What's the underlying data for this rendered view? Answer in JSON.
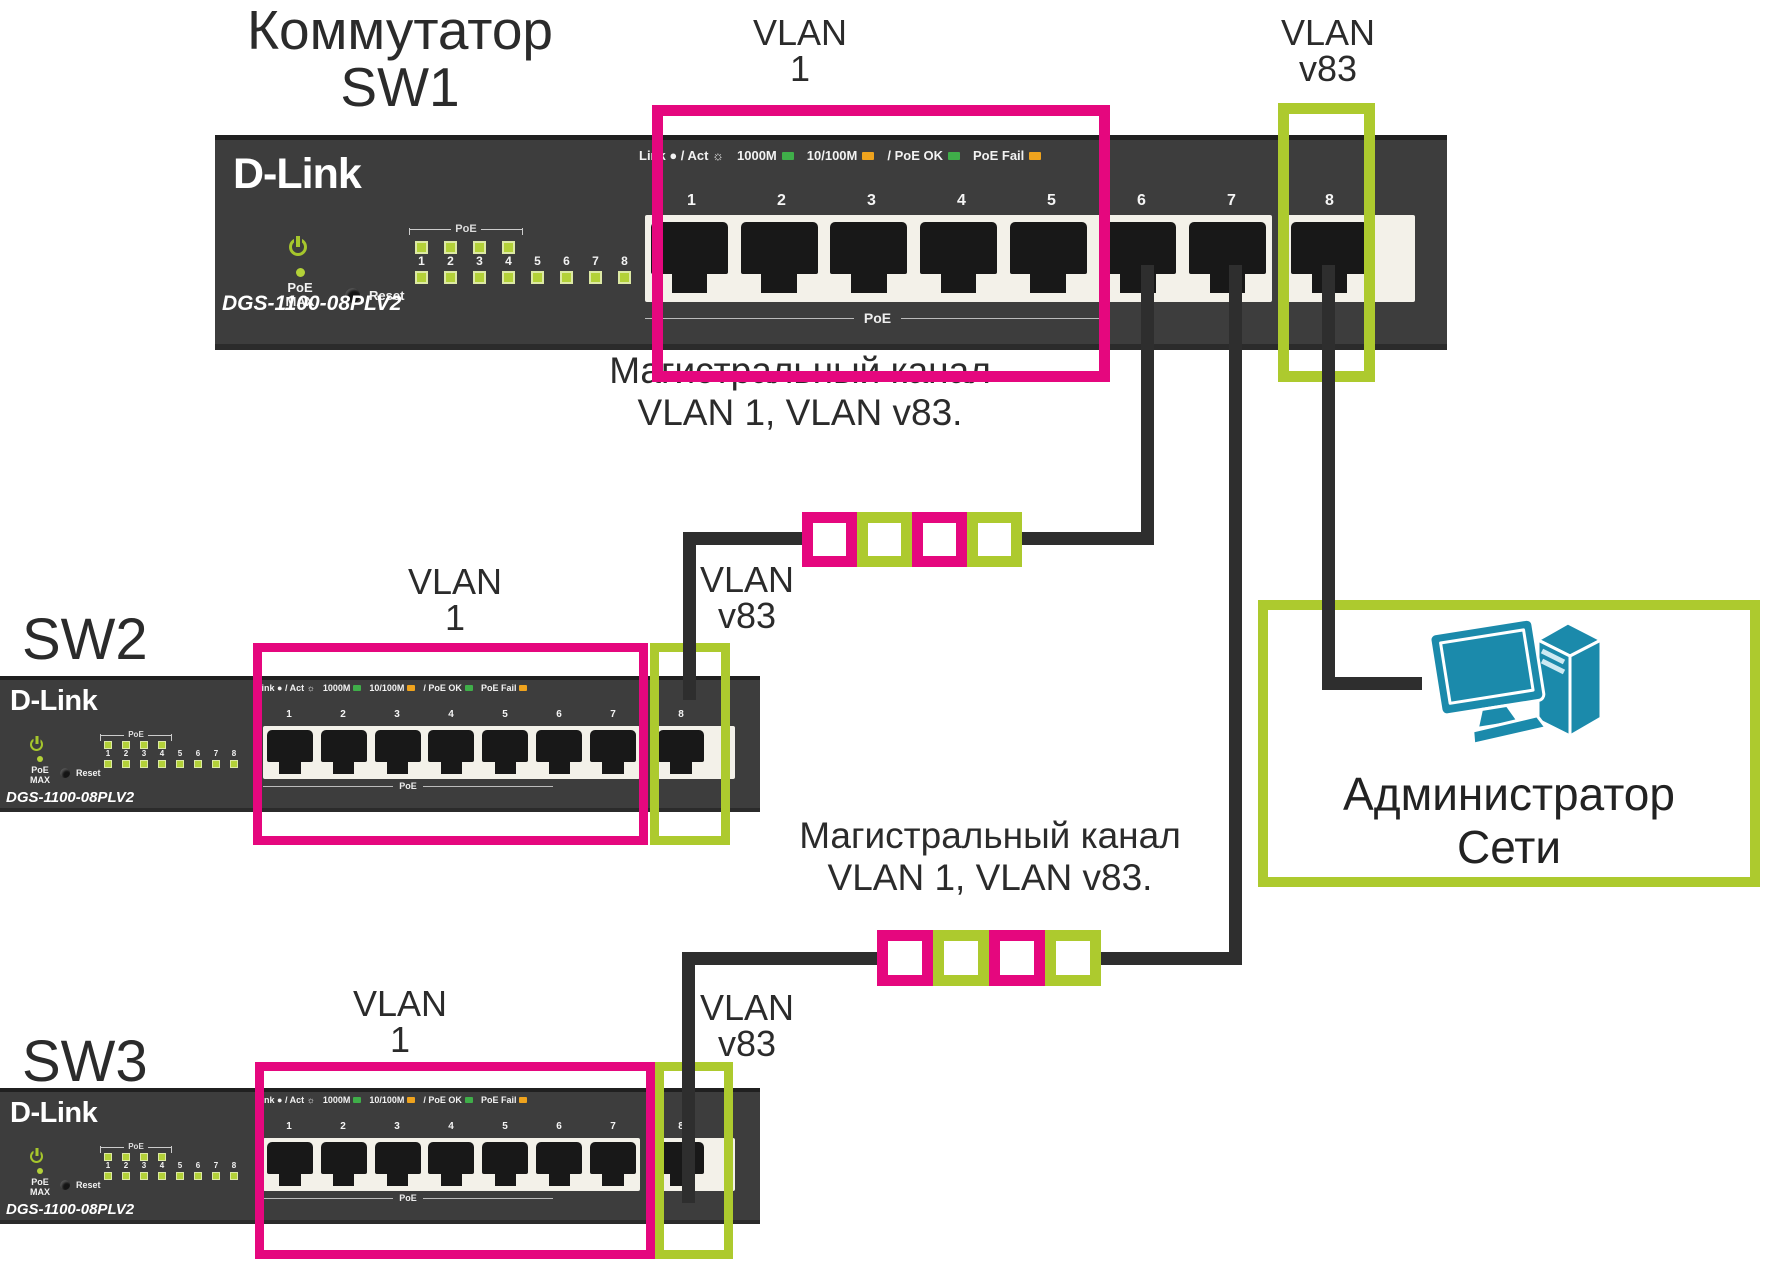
{
  "colors": {
    "magenta": "#e5077e",
    "green": "#adca2e",
    "teal": "#1b8aab",
    "cable": "#2e2e2e",
    "panel": "#3d3d3d",
    "led_green": "#b3d138",
    "legend_green": "#3fae49",
    "legend_orange": "#efa31d"
  },
  "labels": {
    "sw1_title_1": "Коммутатор",
    "sw1_title_2": "SW1",
    "sw2_title": "SW2",
    "sw3_title": "SW3",
    "vlan1_1": "VLAN",
    "vlan1_2": "1",
    "vlan83_1": "VLAN",
    "vlan83_2": "v83",
    "trunk_1": "Магистральный канал",
    "trunk_2": "VLAN 1, VLAN v83.",
    "admin_1": "Администратор",
    "admin_2": "Сети"
  },
  "switch": {
    "brand": "D-Link",
    "model": "DGS-1100-08PLV2",
    "poe_max_1": "PoE",
    "poe_max_2": "MAX",
    "reset": "Reset",
    "poe_bracket": "PoE",
    "poe_under": "PoE",
    "led_numbers": [
      "1",
      "2",
      "3",
      "4",
      "5",
      "6",
      "7",
      "8"
    ],
    "port_numbers": [
      "1",
      "2",
      "3",
      "4",
      "5",
      "6",
      "7",
      "8"
    ],
    "legend": [
      {
        "text": "Link ● / Act ☼"
      },
      {
        "text": "1000M",
        "led": "#3fae49"
      },
      {
        "text": "10/100M",
        "led": "#efa31d"
      },
      {
        "text": "/ PoE OK",
        "led": "#3fae49"
      },
      {
        "text": "PoE Fail",
        "led": "#efa31d"
      }
    ]
  }
}
